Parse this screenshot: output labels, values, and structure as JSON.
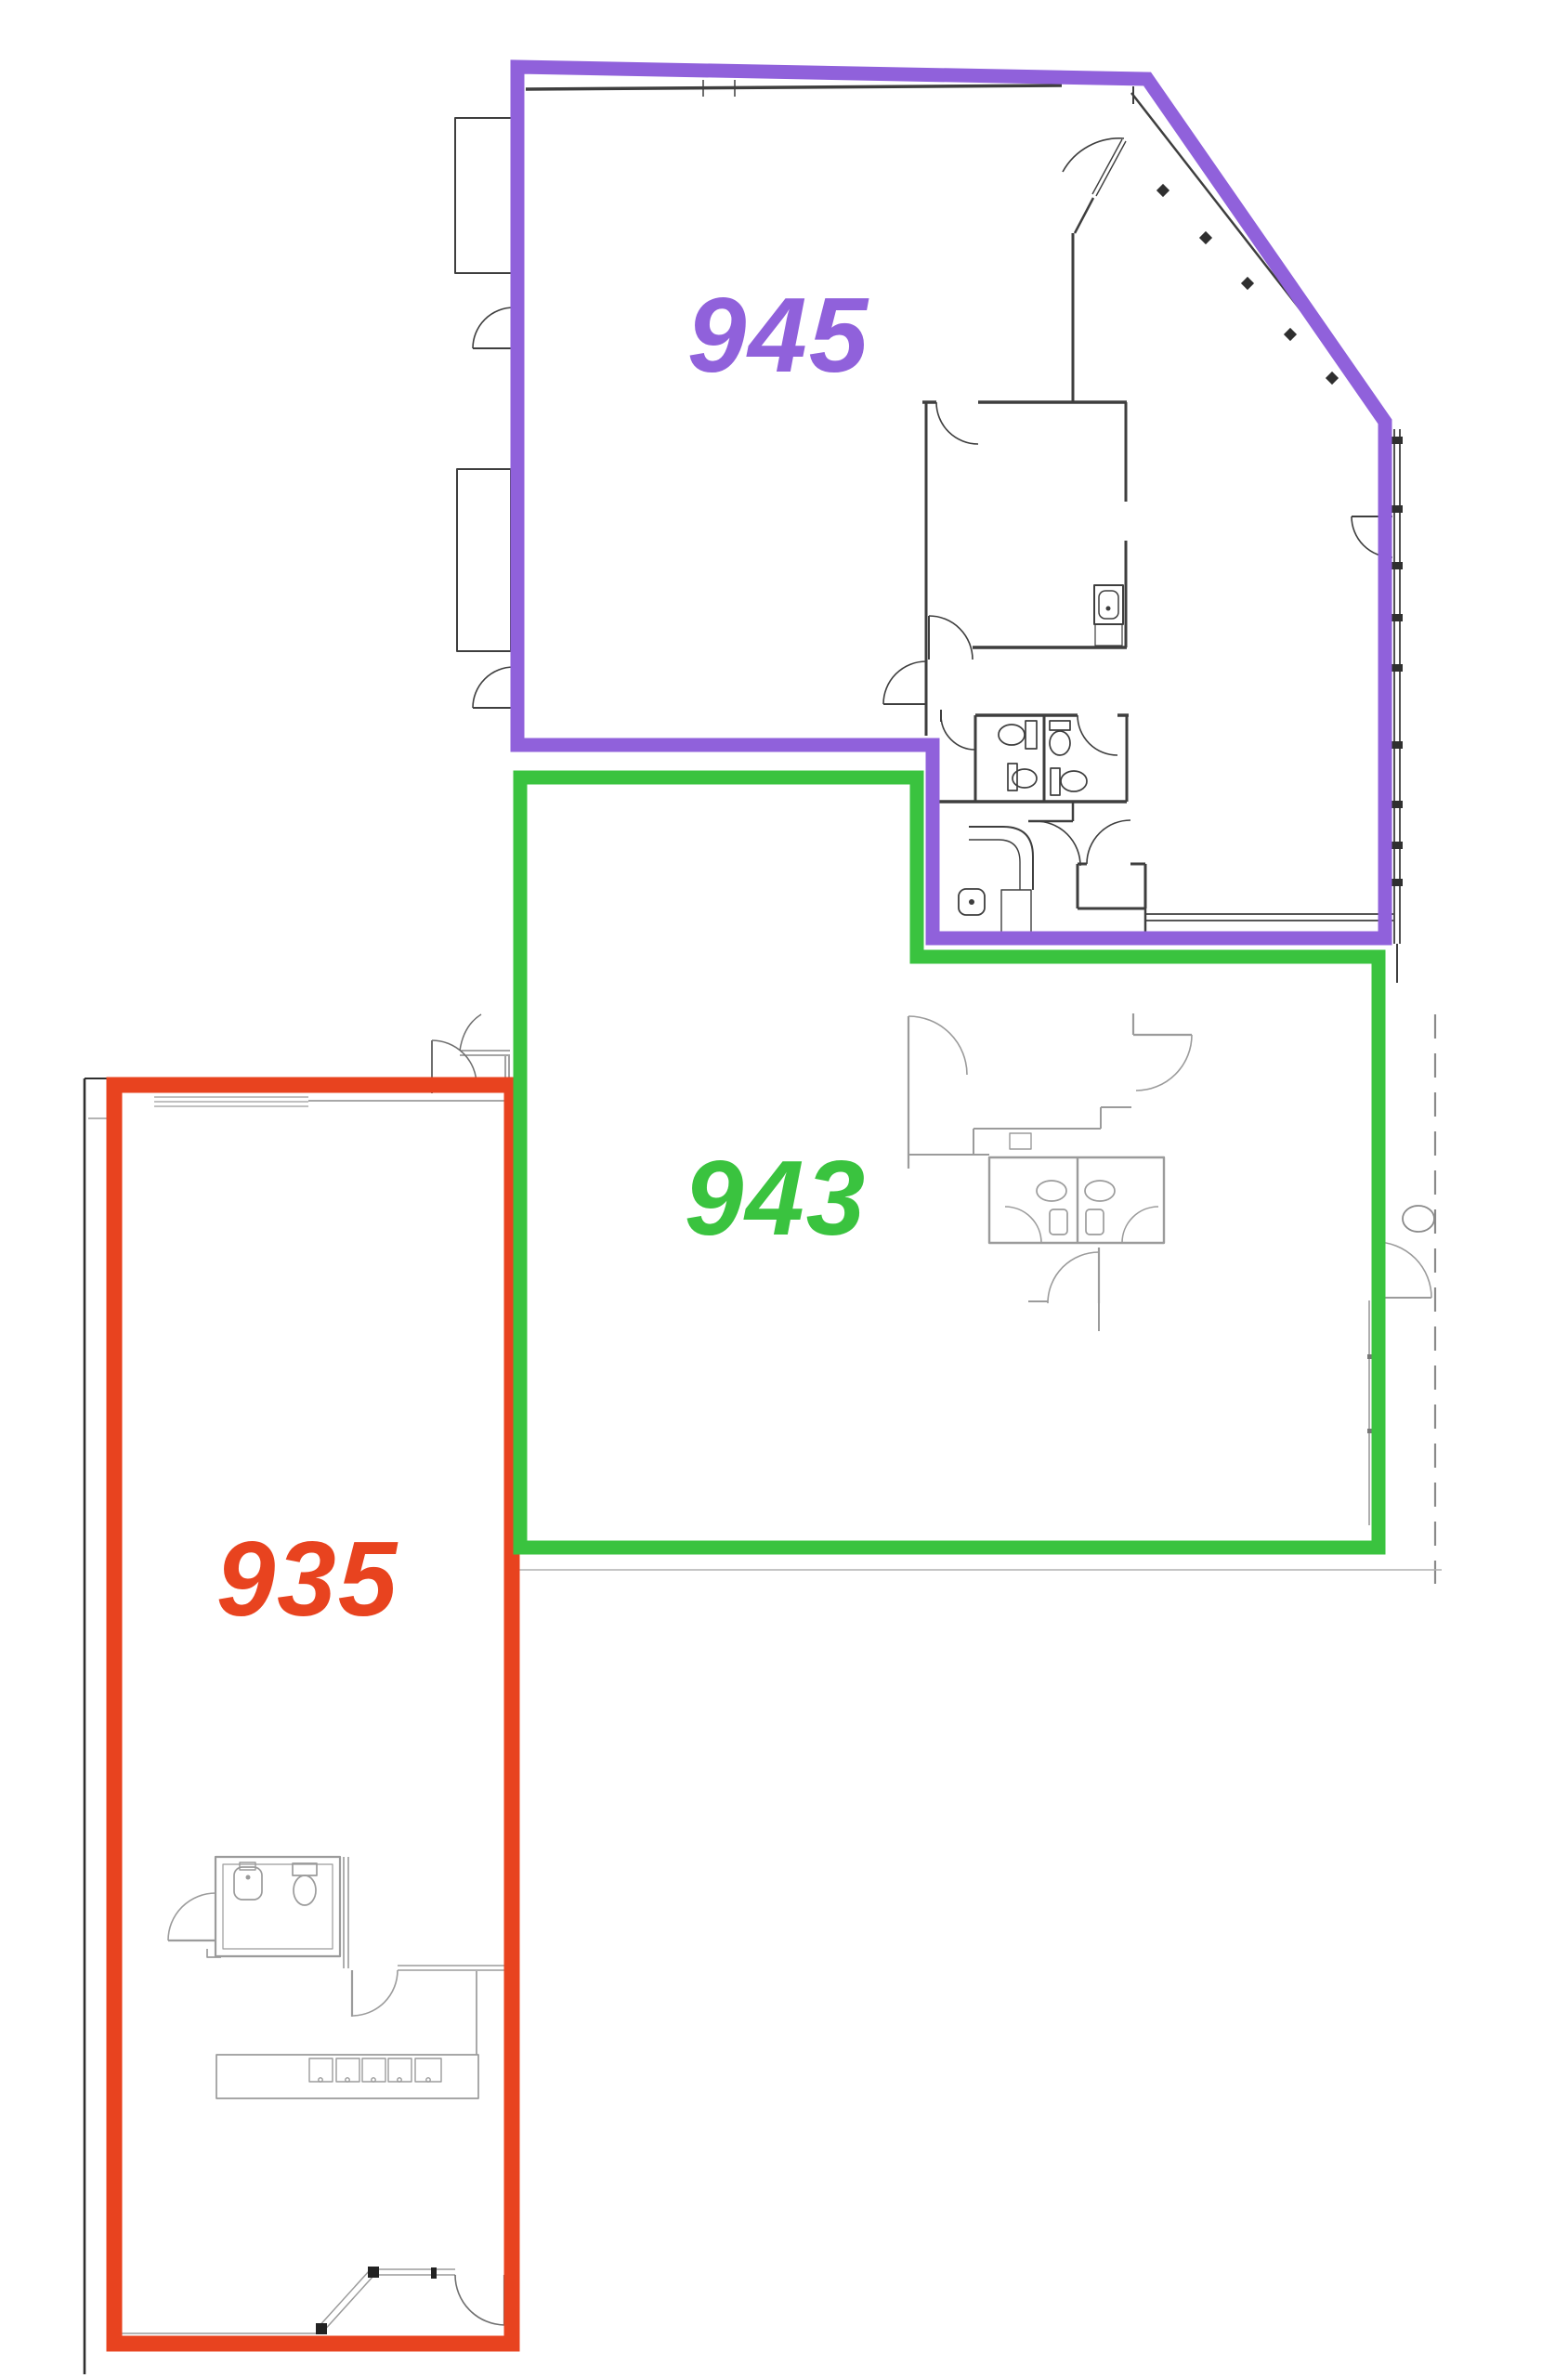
{
  "document": {
    "kind": "floor-plan-screenshot",
    "background": "#ffffff"
  },
  "suites": [
    {
      "number": "945",
      "color": "#9061DB"
    },
    {
      "number": "943",
      "color": "#3AC33F"
    },
    {
      "number": "935",
      "color": "#E8431F"
    }
  ],
  "plan_colors": {
    "wall_dark": "#3e3e3e",
    "wall_light": "#9b9b9b",
    "wall_black": "#2f2f2f",
    "fixture_light": "#8a8a8a",
    "faint": "#b0b0b0"
  }
}
